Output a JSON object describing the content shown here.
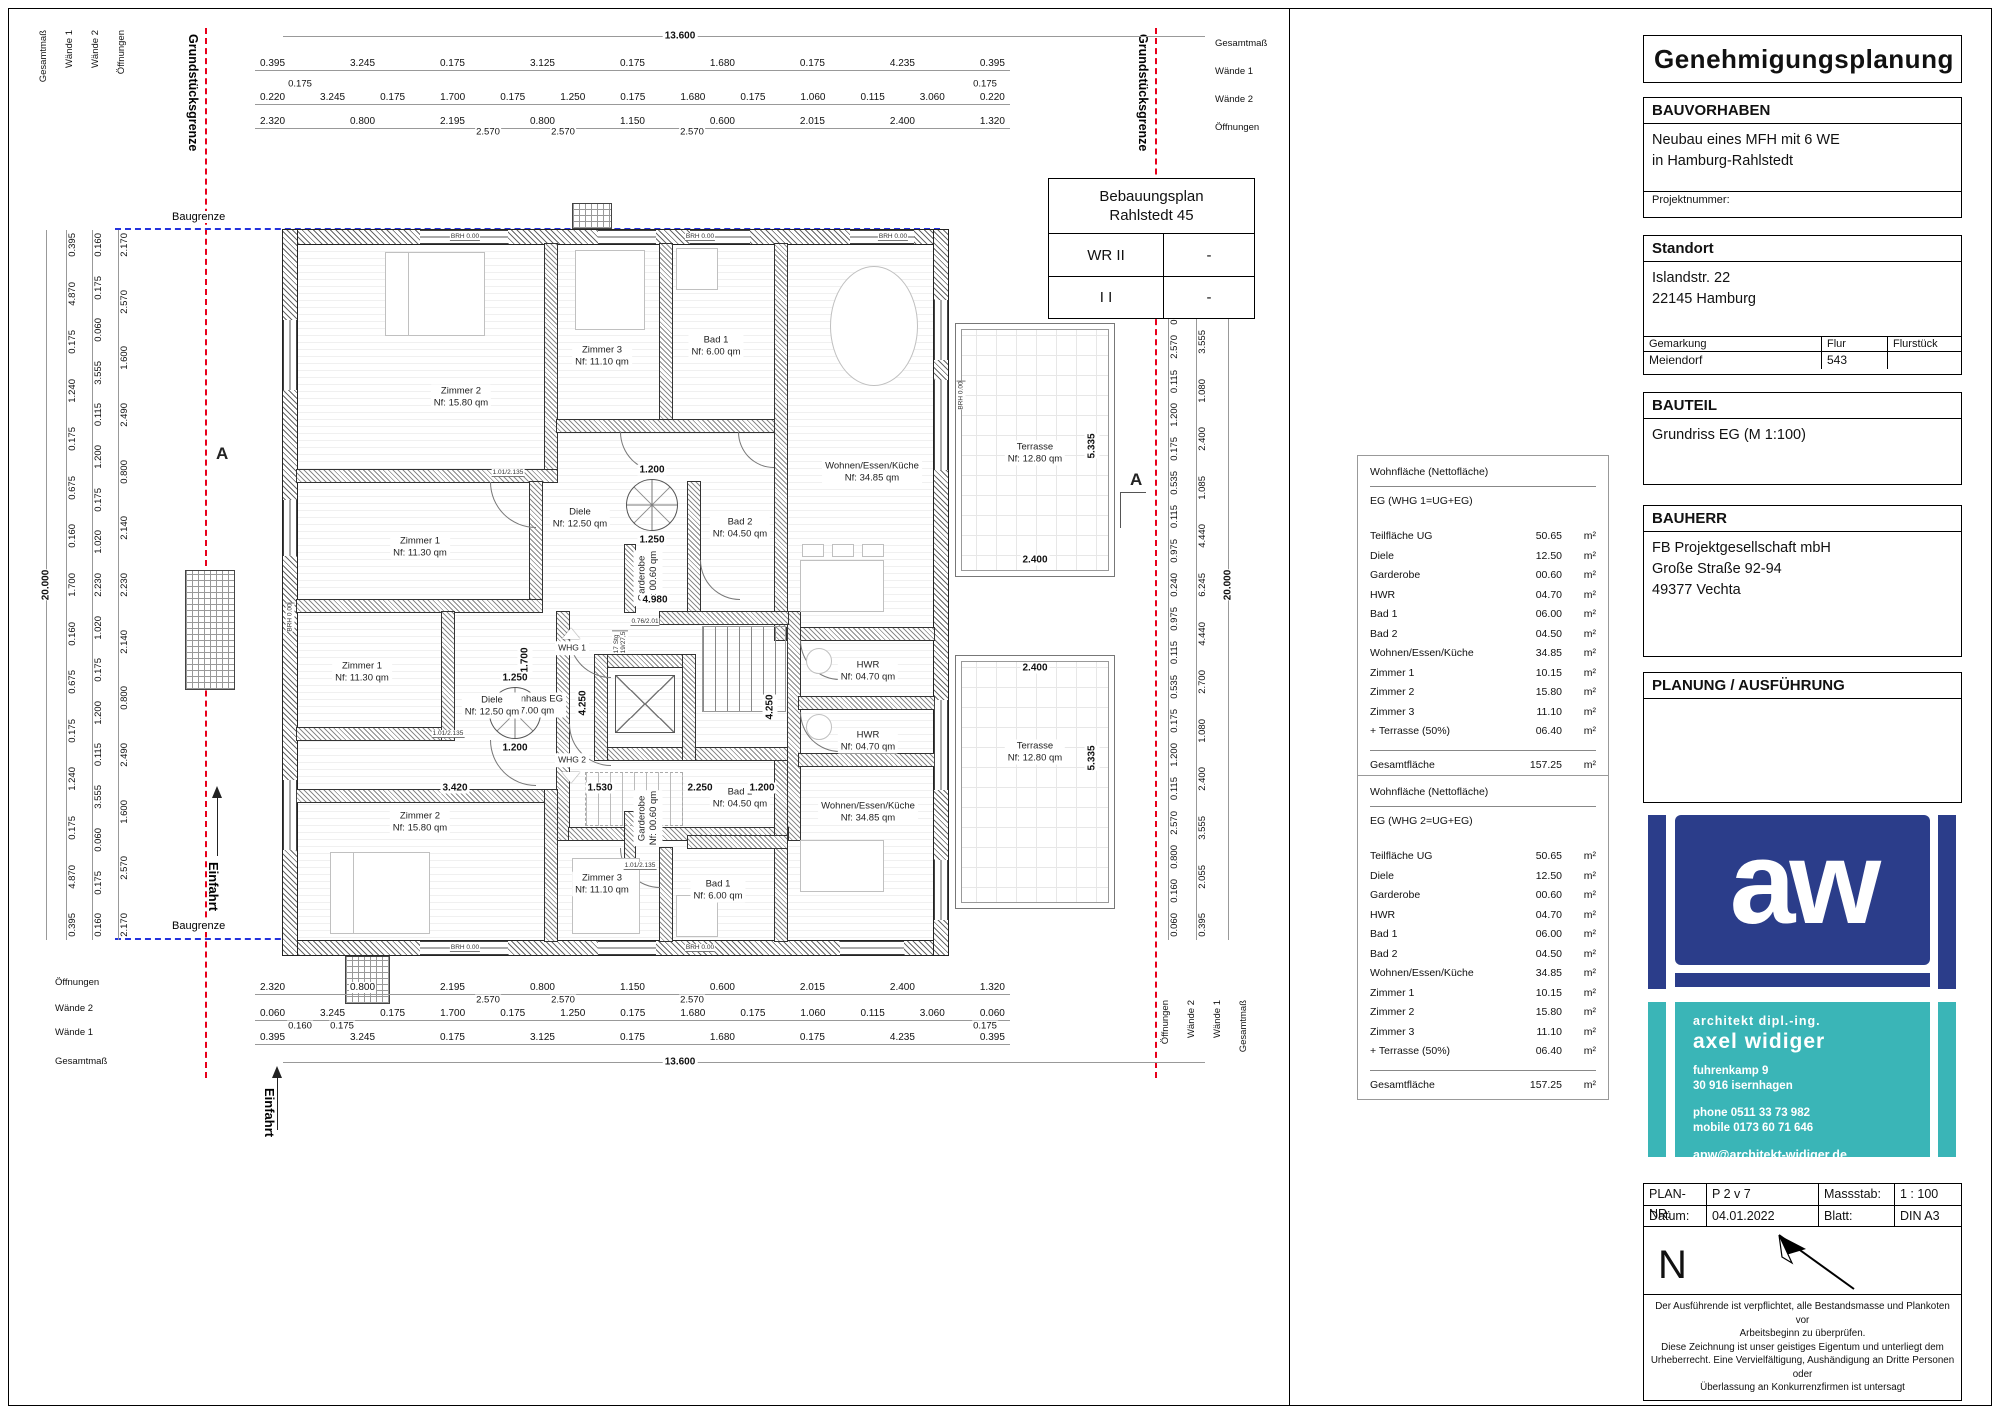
{
  "titleblock": {
    "title": "Genehmigungsplanung",
    "bauvorhaben": {
      "label": "BAUVORHABEN",
      "body": "Neubau eines MFH mit 6 WE\nin Hamburg-Rahlstedt",
      "projekt": "Projektnummer:"
    },
    "standort": {
      "label": "Standort",
      "body": "Islandstr. 22\n22145 Hamburg",
      "gemarkung_label": "Gemarkung",
      "flur_label": "Flur",
      "flurstueck_label": "Flurstück",
      "gemarkung": "Meiendorf",
      "flur": "543",
      "flurstueck": ""
    },
    "bauteil": {
      "label": "BAUTEIL",
      "body": "Grundriss EG (M 1:100)"
    },
    "bauherr": {
      "label": "BAUHERR",
      "body": "FB Projektgesellschaft mbH\nGroße Straße 92-94\n49377 Vechta"
    },
    "planung": {
      "label": "PLANUNG / AUSFÜHRUNG"
    },
    "logo": {
      "monogram": "aw",
      "blue": "#2b3d8a",
      "teal": "#3ab5b7",
      "role": "architekt   dipl.-ing.",
      "name": "axel  widiger",
      "addr1": "fuhrenkamp  9",
      "addr2": "30 916  isernhagen",
      "phone": "phone    0511  33 73 982",
      "mobile": "mobile  0173 60 71 646",
      "email": "apw@architekt-widiger.de"
    },
    "plannr": {
      "k1": "PLAN-NR:",
      "v1": "P 2 v 7",
      "k2": "Massstab:",
      "v2": "1 : 100",
      "k3": "Datum:",
      "v3": "04.01.2022",
      "k4": "Blatt:",
      "v4": "DIN A3"
    },
    "north": "N",
    "disclaimer": "Der Ausführende ist verpflichtet, alle Bestandsmasse und Plankoten vor\nArbeitsbeginn zu überprüfen.\nDiese Zeichnung ist unser geistiges Eigentum und unterliegt dem\nUrheberrecht. Eine Vervielfältigung, Aushändigung an Dritte Personen oder\nÜberlassung an Konkurrenzfirmen ist untersagt"
  },
  "bplan": {
    "title": "Bebauungsplan\nRahlstedt 45",
    "r1c1": "WR II",
    "r1c2": "-",
    "r2c1": "I I",
    "r2c2": "-"
  },
  "wohnflaeche1": {
    "title": "Wohnfläche (Nettofläche)",
    "subtitle": "EG (WHG 1=UG+EG)",
    "rows": [
      {
        "label": "Teilfläche UG",
        "value": "50.65",
        "unit": "m²"
      },
      {
        "label": "Diele",
        "value": "12.50",
        "unit": "m²"
      },
      {
        "label": "Garderobe",
        "value": "00.60",
        "unit": "m²"
      },
      {
        "label": "HWR",
        "value": "04.70",
        "unit": "m²"
      },
      {
        "label": "Bad 1",
        "value": "06.00",
        "unit": "m²"
      },
      {
        "label": "Bad 2",
        "value": "04.50",
        "unit": "m²"
      },
      {
        "label": "Wohnen/Essen/Küche",
        "value": "34.85",
        "unit": "m²"
      },
      {
        "label": "Zimmer 1",
        "value": "10.15",
        "unit": "m²"
      },
      {
        "label": "Zimmer 2",
        "value": "15.80",
        "unit": "m²"
      },
      {
        "label": "Zimmer 3",
        "value": "11.10",
        "unit": "m²"
      },
      {
        "label": "+ Terrasse (50%)",
        "value": "06.40",
        "unit": "m²"
      }
    ],
    "total_label": "Gesamtfläche",
    "total": "157.25",
    "total_unit": "m²"
  },
  "wohnflaeche2": {
    "title": "Wohnfläche (Nettofläche)",
    "subtitle": "EG (WHG 2=UG+EG)",
    "rows": [
      {
        "label": "Teilfläche UG",
        "value": "50.65",
        "unit": "m²"
      },
      {
        "label": "Diele",
        "value": "12.50",
        "unit": "m²"
      },
      {
        "label": "Garderobe",
        "value": "00.60",
        "unit": "m²"
      },
      {
        "label": "HWR",
        "value": "04.70",
        "unit": "m²"
      },
      {
        "label": "Bad 1",
        "value": "06.00",
        "unit": "m²"
      },
      {
        "label": "Bad 2",
        "value": "04.50",
        "unit": "m²"
      },
      {
        "label": "Wohnen/Essen/Küche",
        "value": "34.85",
        "unit": "m²"
      },
      {
        "label": "Zimmer 1",
        "value": "10.15",
        "unit": "m²"
      },
      {
        "label": "Zimmer 2",
        "value": "15.80",
        "unit": "m²"
      },
      {
        "label": "Zimmer 3",
        "value": "11.10",
        "unit": "m²"
      },
      {
        "label": "+ Terrasse (50%)",
        "value": "06.40",
        "unit": "m²"
      }
    ],
    "total_label": "Gesamtfläche",
    "total": "157.25",
    "total_unit": "m²"
  },
  "plan": {
    "grundstuecksgrenze": "Grundstücksgrenze",
    "baugrenze": "Baugrenze",
    "einfahrt": "Einfahrt",
    "section": "A",
    "whg1": "WHG 1",
    "whg2": "WHG 2",
    "labels": {
      "z2a": "Zimmer 2\nNf: 15.80 qm",
      "z3a": "Zimmer 3\nNf: 11.10 qm",
      "bad1a": "Bad 1\nNf: 6.00 qm",
      "weka": "Wohnen/Essen/Küche\nNf: 34.85 qm",
      "z1a": "Zimmer 1\nNf: 11.30 qm",
      "dielea": "Diele\nNf: 12.50 qm",
      "garda": "Garderobe\nNf: 00.60 qm",
      "bad2a": "Bad 2\nNf: 04.50 qm",
      "hwra": "HWR\nNf: 04.70 qm",
      "treppe": "Treppenhaus EG\nNf: 27.00 qm",
      "hwrb": "HWR\nNf: 04.70 qm",
      "z1b": "Zimmer 1\nNf: 11.30 qm",
      "dieleb": "Diele\nNf: 12.50 qm",
      "z2b": "Zimmer 2\nNf: 15.80 qm",
      "z3b": "Zimmer 3\nNf: 11.10 qm",
      "bad1b": "Bad 1\nNf: 6.00 qm",
      "gardb": "Garderobe\nNf: 00.60 qm",
      "bad2b": "Bad 2\nNf: 04.50 qm",
      "wekb": "Wohnen/Essen/Küche\nNf: 34.85 qm",
      "terra": "Terrasse\nNf: 12.80 qm",
      "terrb": "Terrasse\nNf: 12.80 qm"
    },
    "d": {
      "v1200": "1.200",
      "v1250": "1.250",
      "v4980": "4.980",
      "v4250": "4.250",
      "v1700": "1.700",
      "v3420": "3.420",
      "v1530": "1.530",
      "v2250": "2.250",
      "v2400": "2.400",
      "v5335": "5.335",
      "stair": "17 Stg\n19/27,5",
      "brh": "BRH 0.00",
      "door": "1.01/2.135",
      "door2": "0.76/2.01"
    },
    "chains": {
      "lbl_gesamt": "Gesamtmaß",
      "lbl_w1": "Wände 1",
      "lbl_w2": "Wände 2",
      "lbl_off": "Öffnungen",
      "gesamt_h": "13.600",
      "gesamt_v": "20.000",
      "top_w1": [
        "0.395",
        "3.245",
        "0.175",
        "3.125",
        "0.175",
        "1.680",
        "0.175",
        "4.235",
        "0.395"
      ],
      "top_w1_sub": [
        "0.175",
        "0.175"
      ],
      "top_w2": [
        "0.220",
        "3.245",
        "0.175",
        "1.700",
        "0.175",
        "1.250",
        "0.175",
        "1.680",
        "0.175",
        "1.060",
        "0.115",
        "3.060",
        "0.220"
      ],
      "top_off": [
        "2.320",
        "0.800",
        "2.195",
        "0.800",
        "1.150",
        "0.600",
        "2.015",
        "2.400",
        "1.320"
      ],
      "top_off_sub": [
        "2.570",
        "2.570",
        "2.570"
      ],
      "bot_off": [
        "2.320",
        "0.800",
        "2.195",
        "0.800",
        "1.150",
        "0.600",
        "2.015",
        "2.400",
        "1.320"
      ],
      "bot_off_sub": [
        "2.570",
        "2.570",
        "2.570"
      ],
      "bot_w2": [
        "0.060",
        "3.245",
        "0.175",
        "1.700",
        "0.175",
        "1.250",
        "0.175",
        "1.680",
        "0.175",
        "1.060",
        "0.115",
        "3.060",
        "0.060"
      ],
      "bot_w2_sub": [
        "0.160",
        "0.175",
        "0.175"
      ],
      "bot_w1": [
        "0.395",
        "3.245",
        "0.175",
        "3.125",
        "0.175",
        "1.680",
        "0.175",
        "4.235",
        "0.395"
      ],
      "left_w1": [
        "0.395",
        "4.870",
        "0.175",
        "1.240",
        "0.175",
        "0.675",
        "0.160",
        "1.700",
        "0.160",
        "0.675",
        "0.175",
        "1.240",
        "0.175",
        "4.870",
        "0.395"
      ],
      "left_w2": [
        "0.160",
        "0.175",
        "0.060",
        "3.555",
        "0.115",
        "1.200",
        "0.175",
        "1.020",
        "2.230",
        "1.020",
        "0.175",
        "1.200",
        "0.115",
        "3.555",
        "0.060",
        "0.175",
        "0.160"
      ],
      "left_off": [
        "2.170",
        "2.570",
        "1.600",
        "2.490",
        "0.800",
        "2.140",
        "2.230",
        "2.140",
        "0.800",
        "2.490",
        "1.600",
        "2.570",
        "2.170"
      ],
      "right_small": [
        "0.060",
        "0.160",
        "0.800",
        "2.570",
        "0.115",
        "1.200",
        "0.175",
        "0.535",
        "0.115",
        "0.975",
        "0.240",
        "0.975",
        "0.115",
        "0.535",
        "0.175",
        "1.200",
        "0.115",
        "2.570",
        "0.800",
        "0.160",
        "0.060"
      ],
      "right_big": [
        "0.395",
        "2.055",
        "3.555",
        "1.080",
        "2.400",
        "1.085",
        "4.440",
        "6.245",
        "4.440",
        "2.700",
        "1.080",
        "2.400",
        "3.555",
        "2.055",
        "0.395"
      ]
    }
  }
}
